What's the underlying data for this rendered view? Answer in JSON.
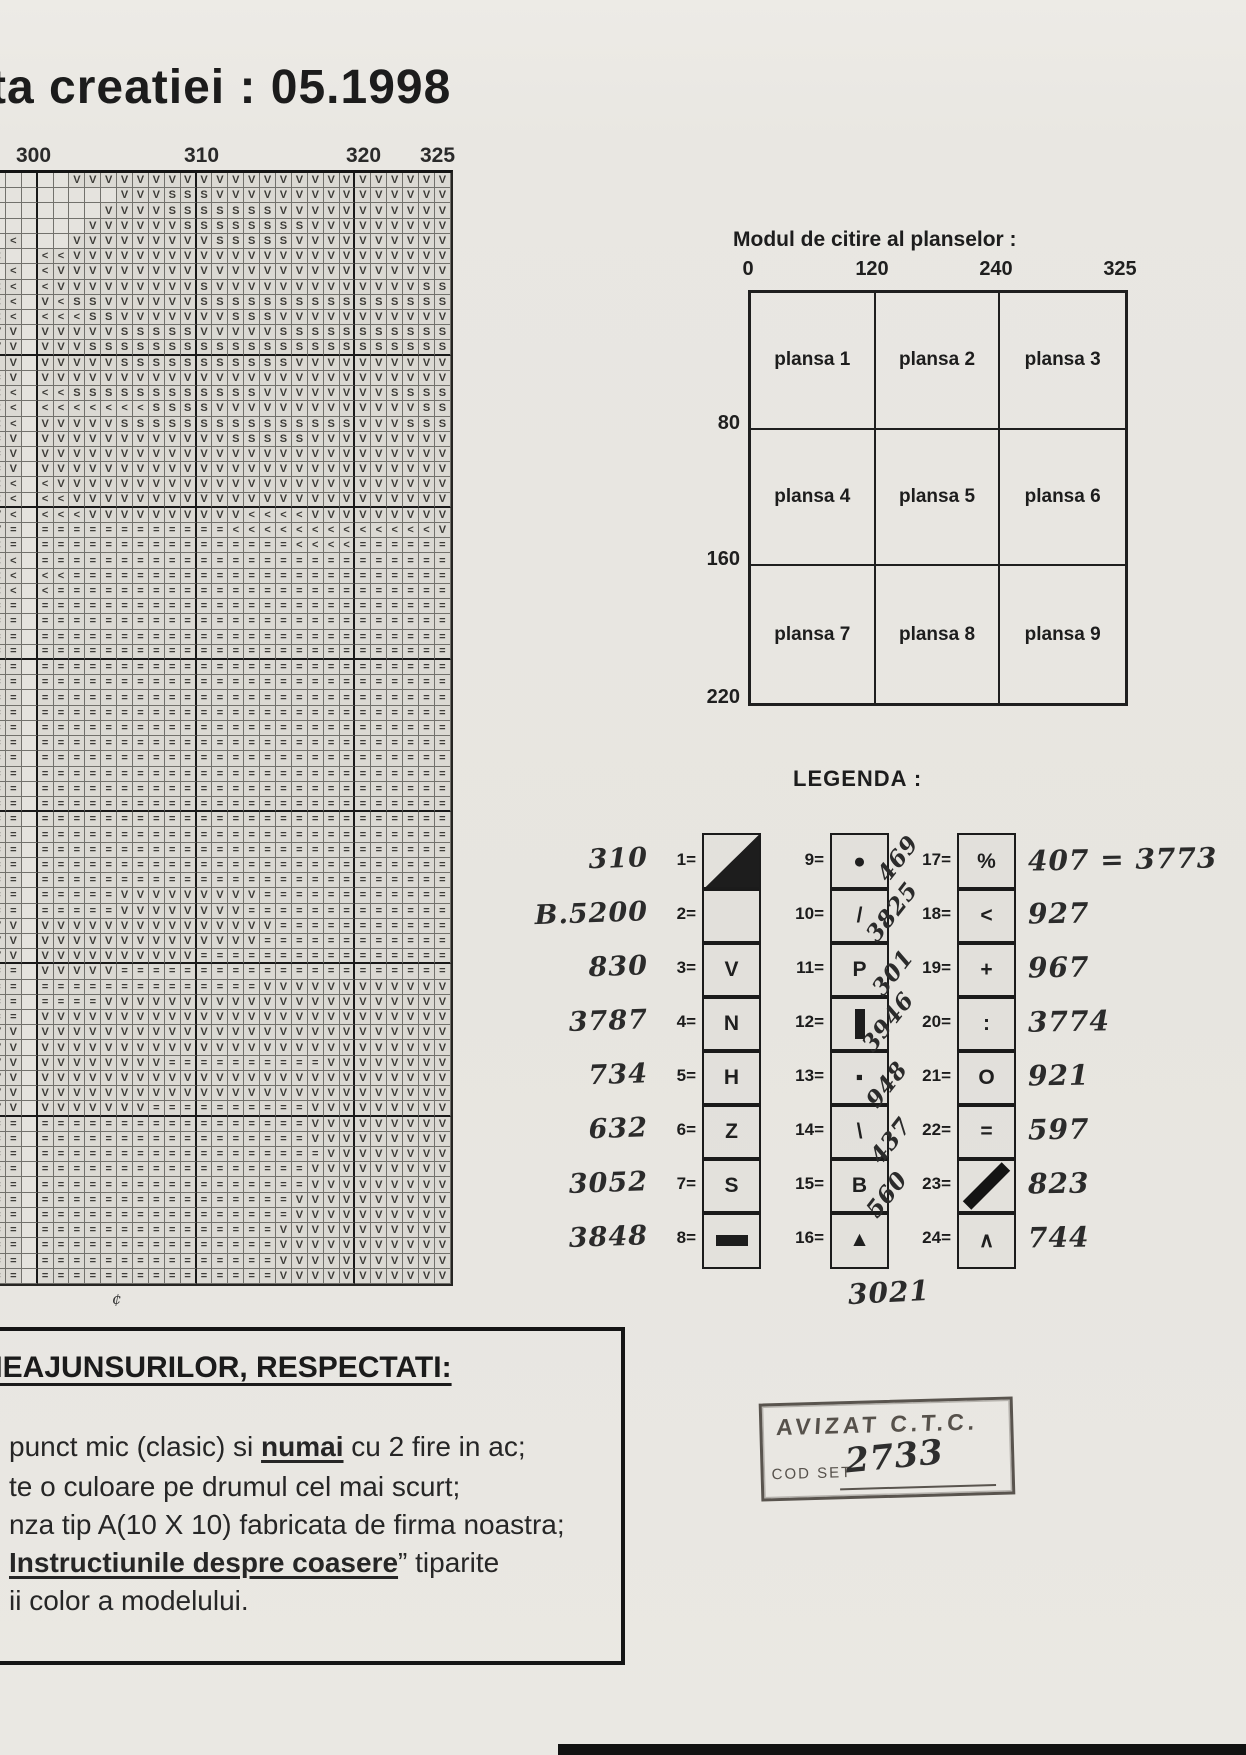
{
  "page": {
    "title": "ta creatiei : 05.1998",
    "stray_mark": "¢"
  },
  "pattern_chart": {
    "top_labels": [
      "300",
      "310",
      "320",
      "325"
    ],
    "symbol_key": {
      ".": "empty",
      "V": "V",
      "S": "S",
      "<": "<",
      "=": "=",
      "·": "dot"
    },
    "rows": [
      ".....VVVVVVVVVVVVVVVVVVVVVVVV",
      "........VVVSSSVVVVVVVVVVVVVVV",
      ".......VVVVSSSSSSSVVVVVVVVVVV",
      "......VVVVVVSSSSSSSSVVVVVVVVV",
      ".<...VVVVVVVVVSSSSSVVVVVVVVVV",
      "<..<<VVVVVVVVVVVVVVVVVVVVVVVV",
      ".<.<VVVVVVVVVVVVVVVVVVVVVVVVV",
      "<<.<VVVVVVVVVSVVVVVVVVVVVVVSS",
      "<<.V<SSVVVVVVSSSSSSSSSSSSSSSS",
      "<<.<<<SSVVVVVVVSSSVVVVVVVVVVV",
      "VV.VVVVVSSSSSVVVVVSSSSSSSSSSS",
      "VV.VVVSSSSSSSSSSSSSSSSSSSSSSS",
      "·V.VVVVVSSSSSSSSSSSVVVVVVVVVV",
      "=V.VVVVVVVVVVVVVVVVVVVVVVVVVV",
      "<<.<<SSSSSSSSSSSSVVVVVVVVSSSS",
      "<<.<<<<<<<SSSSVVVVVVVVVVVVVSS",
      "<<.VVVVVSSSSSSSSSSSSSSSVVVSSS",
      "=V.VVVVVVVVVVVVSSSSSVVVVVVVVV",
      "=V.VVVVVVVVVVVVVVVVVVVVVVVVVV",
      "=V.VVVVVVVVVVVVVVVVVVVVVVVVVV",
      "<<.<VVVVVVVVVVVVVVVVVVVVVVVVV",
      "<<.<<VVVVVVVVVVVVVVVVVVVVVVVV",
      "V<.<<<VVVVVVVVVV<<<<VVVVVVVVV",
      "V=.============<<<<<<<<<<<<<V",
      "<=.================<<<<======",
      "<<.==========================",
      "<<.<<========================",
      "<<.<=========================",
      "==.==========================",
      "==.==========================",
      "==.==========================",
      "==.==========================",
      "==.==========================",
      "==.==========================",
      "==.==========================",
      "==.==========================",
      "==.==========================",
      "==.==========================",
      "==.==========================",
      "==.==========================",
      "==.==========================",
      "==.==========================",
      "==.==========================",
      "==.==========================",
      "==.==========================",
      "==.==========================",
      "==.==========================",
      "==.=====VVVVVVVVV============",
      "==.=====VVVVVVVV=============",
      "VV.VVVVVVVVVVVVVVV===========",
      "VV.VVVVVVVVVVVVVV============",
      "VV.VVVVVVVVVV================",
      "==.VVVVV=====================",
      "==.==============VVVVVVVVVVVV",
      "==.====VVVVVVVVVVVVVVVVVVVVVV",
      "==.VVVVVVVVVVVVVVVVVVVVVVVVVV",
      "VV.VVVVVVVVVVVVVVVVVVVVVVVVVV",
      "VV.VVVVVVVVVVVVVVVVVVVVVVVVVV",
      "VV.VVVVVVVV==========VVVVVVVV",
      "VV.VVVVVVVVVVVVVVVVVVVVVVVVVV",
      "VV.VVVVVVVVVVVVVVVVVVVVVVVVVV",
      "VV.VVVVVVV==========VVVVVVVVV",
      "==.=================VVVVVVVVV",
      "==.=================VVVVVVVVV",
      "==.==================VVVVVVVV",
      "==.=================VVVVVVVVV",
      "==.=================VVVVVVVVV",
      "==.================VVVVVVVVVV",
      "==.================VVVVVVVVVV",
      "==.===============VVVVVVVVVVV",
      "==.===============VVVVVVVVVVV",
      "==.===============VVVVVVVVVVV",
      "==.===============VVVVVVVVVVV"
    ]
  },
  "plansa": {
    "title": "Modul de citire al planselor :",
    "col_labels": [
      "0",
      "120",
      "240",
      "325"
    ],
    "row_labels": [
      "80",
      "160",
      "220"
    ],
    "cells": [
      [
        "plansa 1",
        "plansa 2",
        "plansa 3"
      ],
      [
        "plansa 4",
        "plansa 5",
        "plansa 6"
      ],
      [
        "plansa 7",
        "plansa 8",
        "plansa 9"
      ]
    ]
  },
  "legend": {
    "title": "LEGENDA :",
    "col1": [
      {
        "n": "1=",
        "sym": "tri",
        "hand": "310"
      },
      {
        "n": "2=",
        "sym": "",
        "hand": "B.5200"
      },
      {
        "n": "3=",
        "sym": "V",
        "hand": "830"
      },
      {
        "n": "4=",
        "sym": "N",
        "hand": "3787"
      },
      {
        "n": "5=",
        "sym": "H",
        "hand": "734"
      },
      {
        "n": "6=",
        "sym": "Z",
        "hand": "632"
      },
      {
        "n": "7=",
        "sym": "S",
        "hand": "3052"
      },
      {
        "n": "8=",
        "sym": "bar",
        "hand": "3848"
      }
    ],
    "col2": [
      {
        "n": "9=",
        "sym": "●"
      },
      {
        "n": "10=",
        "sym": "/"
      },
      {
        "n": "11=",
        "sym": "P"
      },
      {
        "n": "12=",
        "sym": "vbar"
      },
      {
        "n": "13=",
        "sym": "▪"
      },
      {
        "n": "14=",
        "sym": "\\"
      },
      {
        "n": "15=",
        "sym": "B"
      },
      {
        "n": "16=",
        "sym": "▲"
      }
    ],
    "col3": [
      {
        "n": "17=",
        "sym": "%",
        "hand": "407 = 3773"
      },
      {
        "n": "18=",
        "sym": "<",
        "hand": "927"
      },
      {
        "n": "19=",
        "sym": "+",
        "hand": "967"
      },
      {
        "n": "20=",
        "sym": ":",
        "hand": "3774"
      },
      {
        "n": "21=",
        "sym": "O",
        "hand": "921"
      },
      {
        "n": "22=",
        "sym": "=",
        "hand": "597"
      },
      {
        "n": "23=",
        "sym": "diag",
        "hand": "823"
      },
      {
        "n": "24=",
        "sym": "∧",
        "hand": "744"
      }
    ],
    "diagonal_numbers": [
      "469",
      "3825",
      "301",
      "3946",
      "948",
      "437",
      "560"
    ],
    "footer_number": "3021"
  },
  "instructions": {
    "heading": "NEAJUNSURILOR, RESPECTATI:",
    "lines": [
      {
        "pre": "punct mic (clasic) si ",
        "bold": "numai",
        "post": " cu 2 fire in ac;"
      },
      {
        "pre": "te o culoare pe drumul cel mai scurt;",
        "bold": "",
        "post": ""
      },
      {
        "pre": "nza tip A(10 X 10) fabricata de firma noastra;",
        "bold": "",
        "post": ""
      },
      {
        "pre": "",
        "bold": "Instructiunile despre coasere",
        "post": "” tiparite"
      },
      {
        "pre": "ii color a modelului.",
        "bold": "",
        "post": ""
      }
    ]
  },
  "stamp": {
    "line1": "AVIZAT C.T.C.",
    "cod_label": "COD SET",
    "code": "2733"
  }
}
